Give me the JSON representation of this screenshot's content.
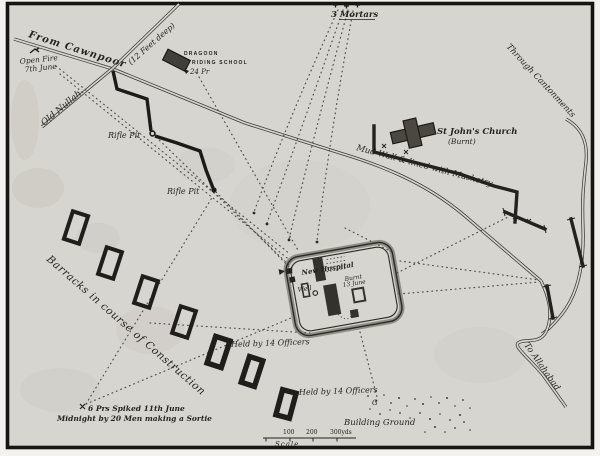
{
  "roads": {
    "from_cawnpoor": "From Cawnpoor",
    "old_nullah": "Old Nullah",
    "nullah_depth": "(12 Feet deep)",
    "through_cantonments": "Through Cantonments",
    "to_allahabad": "To Allahabad"
  },
  "artillery": {
    "open_fire_line1": "Open Fire",
    "open_fire_line2": "7th June",
    "mortars": "3 Mortars",
    "gun_24pr": "24 Pr",
    "spiked_line1": "6 Prs Spiked 11th June",
    "spiked_line2": "Midnight by 20 Men making a Sortie"
  },
  "buildings": {
    "dragoon_line1": "DRAGOON",
    "dragoon_line2": "RIDING SCHOOL",
    "church_line1": "St John's Church",
    "church_line2": "(Burnt)",
    "barracks_note": "Barracks in course of Construction",
    "building_ground": "Building Ground"
  },
  "defenses": {
    "mud_wall": "Mud Wall & lined with Musketry",
    "rifle_pit_upper": "Rifle Pit",
    "rifle_pit_lower": "Rifle Pit",
    "held_upper": "Held by 14 Officers",
    "held_lower": "Held by 14 Officers"
  },
  "entrenchment": {
    "hospital": "New Hospital",
    "burnt": "Burnt",
    "burnt_date": "13 June",
    "well": "Well",
    "g_marker": "G"
  },
  "scale": {
    "t100": "100",
    "t200": "200",
    "t300": "300yds",
    "label": "Scale"
  },
  "colors": {
    "paper": "#d7d5cf",
    "ink": "#26241f",
    "border": "#161511"
  }
}
